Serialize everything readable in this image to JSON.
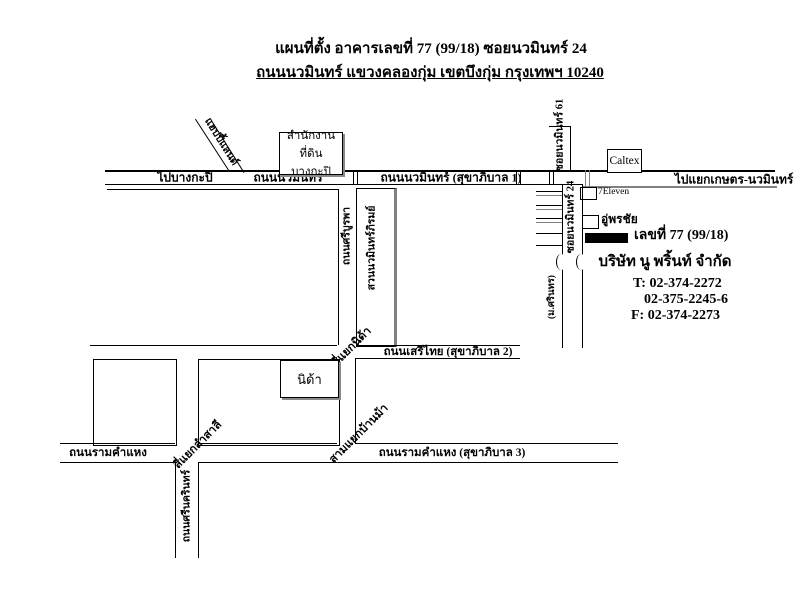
{
  "title": {
    "line1": "แผนที่ตั้ง อาคารเลขที่ 77 (99/18) ซอยนวมินทร์ 24",
    "line2": "ถนนนวมินทร์ แขวงคลองกุ่ม เขตบึงกุ่ม กรุงเทพฯ 10240"
  },
  "roads": {
    "to_bangkapi": "ไปบางกะปิ",
    "nawamin": "ถนนนวมินทร์",
    "nawamin_sukhaphiban1": "ถนนนวมินทร์ (สุขาภิบาล 1)",
    "to_kaset_nawamin": "ไปแยกเกษตร-นวมินทร์",
    "soi_nawamin_61": "ซอยนวมินทร์ 61",
    "soi_nawamin_24": "ซอยนวมินทร์ 24",
    "sri_burapha": "ถนนศรีบูรพา",
    "seri_thai": "ถนนเสรีไทย (สุขาภิบาล 2)",
    "ramkhamhaeng": "ถนนรามคำแหง",
    "ramkhamhaeng_sukhaphiban3": "ถนนรามคำแหง (สุขาภิบาล 3)",
    "srinagarindra": "ถนนศรีนครินทร์",
    "happy_land": "แฮปปี้แลนด์",
    "village": "(ม.ศรินทร)"
  },
  "junctions": {
    "nida": "สี่แยกนิด้า",
    "lam_sali": "สี่แยกลำสาลี",
    "ban_ma": "สามแยกบ้านม้า"
  },
  "places": {
    "land_office_line1": "สำนักงานที่ดิน",
    "land_office_line2": "บางกะปิ",
    "caltex": "Caltex",
    "seven_eleven": "7Eleven",
    "pornchai_garage": "อู่พรชัย",
    "nida": "นิด้า",
    "park": "สวนนวมินทร์ภิรมย์"
  },
  "building": {
    "address": "เลขที่ 77 (99/18)",
    "company": "บริษัท นู พริ้นท์ จำกัด",
    "tel1": "T: 02-374-2272",
    "tel2": "02-375-2245-6",
    "fax": "F: 02-374-2273"
  },
  "colors": {
    "line": "#000000",
    "secondary_line": "#808080",
    "building_fill": "#000000"
  }
}
